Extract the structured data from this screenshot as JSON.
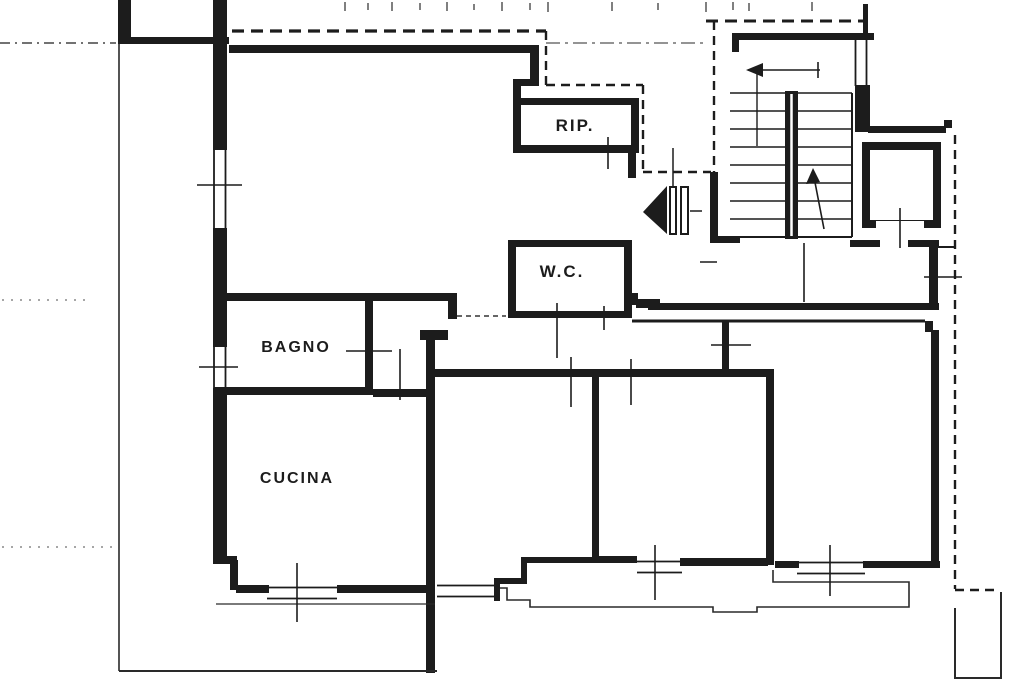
{
  "document": {
    "type": "architectural floor plan",
    "style": "black-and-white scanned blueprint of an apartment with stairwell and elevator"
  },
  "labels": {
    "rip": "RIP.",
    "wc": "W.C.",
    "bagno": "BAGNO",
    "cucina": "CUCINA"
  },
  "symbols": {
    "entrance_door": "door-swing-triangle-icon",
    "stair_direction": "stair-up-arrow-icon",
    "elevator": "elevator-shaft-icon",
    "windows": "double-line-window-icon",
    "balconies": "dashed-outline-balcony"
  },
  "colors": {
    "ink": "#1c1c1c",
    "paper": "#ffffff",
    "faint_ink": "#777777"
  }
}
